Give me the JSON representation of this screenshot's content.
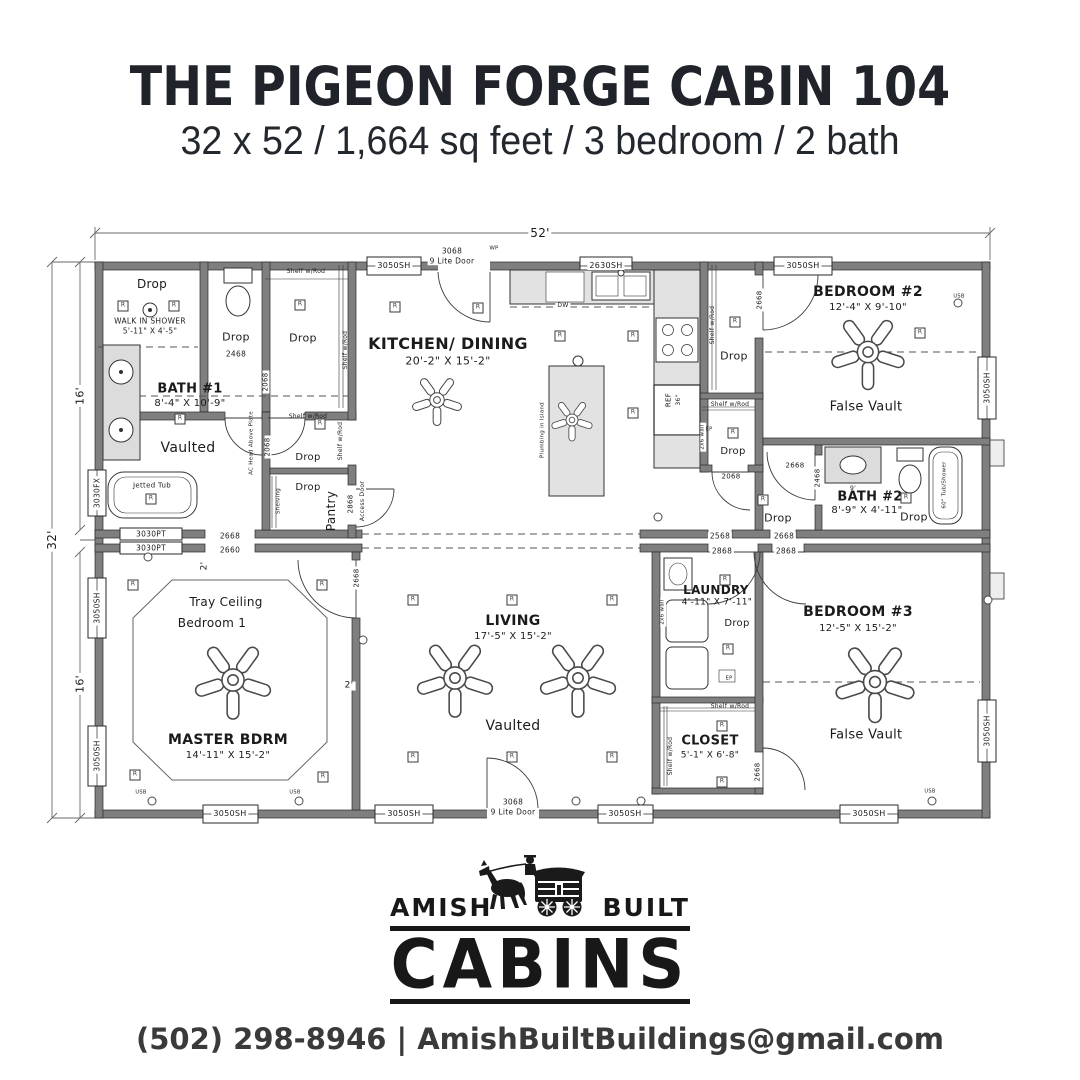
{
  "header": {
    "title": "THE PIGEON FORGE CABIN 104",
    "subtitle": "32 x 52 / 1,664 sq feet / 3 bedroom / 2 bath"
  },
  "logo": {
    "left": "AMISH",
    "right": "BUILT",
    "main": "CABINS"
  },
  "contact": {
    "line": "(502) 298-8946 | AmishBuiltBuildings@gmail.com"
  },
  "plan": {
    "colors": {
      "wall": "#7f7f7f",
      "counter": "#e2e2e2",
      "line": "#2b2b2b"
    },
    "labels": [
      {
        "t": "52'",
        "x": 540,
        "y": 233,
        "s": 12,
        "bg": 1
      },
      {
        "t": "32'",
        "x": 52,
        "y": 540,
        "s": 12,
        "r": -90,
        "bg": 1
      },
      {
        "t": "16'",
        "x": 80,
        "y": 396,
        "s": 11,
        "r": -90,
        "bg": 1
      },
      {
        "t": "16'",
        "x": 80,
        "y": 684,
        "s": 11,
        "r": -90,
        "bg": 1
      },
      {
        "t": "3050SH",
        "x": 394,
        "y": 266,
        "s": 8,
        "bg": 1
      },
      {
        "t": "3068",
        "x": 452,
        "y": 251,
        "s": 7.5,
        "bg": 1
      },
      {
        "t": "9 Lite Door",
        "x": 452,
        "y": 261,
        "s": 7.5,
        "bg": 1
      },
      {
        "t": "WP",
        "x": 494,
        "y": 249,
        "s": 5.5
      },
      {
        "t": "2630SH",
        "x": 606,
        "y": 266,
        "s": 8,
        "bg": 1
      },
      {
        "t": "3050SH",
        "x": 803,
        "y": 266,
        "s": 8,
        "bg": 1
      },
      {
        "t": "3030FX",
        "x": 97,
        "y": 493,
        "s": 7.5,
        "r": -90,
        "bg": 1
      },
      {
        "t": "3050SH",
        "x": 97,
        "y": 608,
        "s": 7.5,
        "r": -90,
        "bg": 1
      },
      {
        "t": "3050SH",
        "x": 97,
        "y": 756,
        "s": 7.5,
        "r": -90,
        "bg": 1
      },
      {
        "t": "3050SH",
        "x": 987,
        "y": 388,
        "s": 7.5,
        "r": -90,
        "bg": 1
      },
      {
        "t": "3050SH",
        "x": 987,
        "y": 731,
        "s": 7.5,
        "r": -90,
        "bg": 1
      },
      {
        "t": "3050SH",
        "x": 230,
        "y": 814,
        "s": 8,
        "bg": 1
      },
      {
        "t": "3050SH",
        "x": 404,
        "y": 814,
        "s": 8,
        "bg": 1
      },
      {
        "t": "3068",
        "x": 513,
        "y": 802,
        "s": 7.5,
        "bg": 1
      },
      {
        "t": "9 Lite Door",
        "x": 513,
        "y": 812,
        "s": 7.5,
        "bg": 1
      },
      {
        "t": "3050SH",
        "x": 625,
        "y": 814,
        "s": 8,
        "bg": 1
      },
      {
        "t": "3050SH",
        "x": 869,
        "y": 814,
        "s": 8,
        "bg": 1
      },
      {
        "t": "3030PT",
        "x": 151,
        "y": 534,
        "s": 7.5,
        "bg": 1
      },
      {
        "t": "3030PT",
        "x": 151,
        "y": 548,
        "s": 7.5,
        "bg": 1
      },
      {
        "t": "2668",
        "x": 230,
        "y": 536,
        "s": 7.5,
        "bg": 1
      },
      {
        "t": "2660",
        "x": 230,
        "y": 550,
        "s": 7.5,
        "bg": 1
      },
      {
        "t": "2568",
        "x": 720,
        "y": 536,
        "s": 7.5,
        "bg": 1
      },
      {
        "t": "2668",
        "x": 784,
        "y": 536,
        "s": 7.5,
        "bg": 1
      },
      {
        "t": "2868",
        "x": 722,
        "y": 551,
        "s": 7.5,
        "bg": 1
      },
      {
        "t": "2868",
        "x": 786,
        "y": 551,
        "s": 7.5,
        "bg": 1
      },
      {
        "t": "Drop",
        "x": 152,
        "y": 284,
        "s": 12
      },
      {
        "t": "WALK IN SHOWER",
        "x": 150,
        "y": 321,
        "s": 7.5
      },
      {
        "t": "5'-11\" X 4'-5\"",
        "x": 150,
        "y": 331,
        "s": 7.5
      },
      {
        "t": "Drop",
        "x": 236,
        "y": 337,
        "s": 11
      },
      {
        "t": "2468",
        "x": 236,
        "y": 354,
        "s": 7.5
      },
      {
        "t": "Drop",
        "x": 303,
        "y": 338,
        "s": 11
      },
      {
        "t": "Shelf w/Rod",
        "x": 306,
        "y": 272,
        "s": 6
      },
      {
        "t": "Shelf w/Rod",
        "x": 346,
        "y": 350,
        "s": 6,
        "r": -90
      },
      {
        "t": "2068",
        "x": 266,
        "y": 382,
        "s": 7,
        "r": -90,
        "bg": 1
      },
      {
        "t": "BATH #1",
        "x": 190,
        "y": 389,
        "s": 13,
        "b": 1
      },
      {
        "t": "8'-4\" X 10'-9\"",
        "x": 190,
        "y": 404,
        "s": 10
      },
      {
        "t": "Vaulted",
        "x": 188,
        "y": 448,
        "s": 14
      },
      {
        "t": "Jetted Tub",
        "x": 152,
        "y": 486,
        "s": 7
      },
      {
        "t": "AC Head Above Plate",
        "x": 252,
        "y": 443,
        "s": 5.5,
        "r": -90
      },
      {
        "t": "2068",
        "x": 268,
        "y": 447,
        "s": 7,
        "r": -90,
        "bg": 1
      },
      {
        "t": "Shelf w/Rod",
        "x": 308,
        "y": 417,
        "s": 6
      },
      {
        "t": "Shelf w/Rod",
        "x": 341,
        "y": 441,
        "s": 6,
        "r": -90
      },
      {
        "t": "Drop",
        "x": 308,
        "y": 458,
        "s": 10
      },
      {
        "t": "Shelving",
        "x": 279,
        "y": 501,
        "s": 5.5,
        "r": -90
      },
      {
        "t": "Drop",
        "x": 308,
        "y": 488,
        "s": 10
      },
      {
        "t": "Pantry",
        "x": 331,
        "y": 511,
        "s": 12,
        "r": -90
      },
      {
        "t": "2868",
        "x": 351,
        "y": 504,
        "s": 7,
        "r": -90,
        "bg": 1
      },
      {
        "t": "Access Door",
        "x": 363,
        "y": 501,
        "s": 6,
        "r": -90,
        "bg": 1
      },
      {
        "t": "KITCHEN/ DINING",
        "x": 448,
        "y": 344,
        "s": 16,
        "b": 1
      },
      {
        "t": "20'-2\" X 15'-2\"",
        "x": 448,
        "y": 361,
        "s": 11
      },
      {
        "t": "DW",
        "x": 563,
        "y": 306,
        "s": 6,
        "bg": 1
      },
      {
        "t": "Plumbing in Island",
        "x": 543,
        "y": 430,
        "s": 5.5,
        "r": -90
      },
      {
        "t": "REF",
        "x": 669,
        "y": 400,
        "s": 7,
        "r": -90
      },
      {
        "t": "36\"",
        "x": 679,
        "y": 400,
        "s": 6,
        "r": -90
      },
      {
        "t": "2x6 wall",
        "x": 703,
        "y": 437,
        "s": 5.5,
        "r": -90,
        "bg": 1
      },
      {
        "t": "Shelf w/Rod",
        "x": 713,
        "y": 325,
        "s": 6,
        "r": -90
      },
      {
        "t": "2668",
        "x": 760,
        "y": 300,
        "s": 7,
        "r": -90,
        "bg": 1
      },
      {
        "t": "Drop",
        "x": 734,
        "y": 356,
        "s": 11
      },
      {
        "t": "BEDROOM #2",
        "x": 868,
        "y": 292,
        "s": 14,
        "b": 1
      },
      {
        "t": "12'-4\" X 9'-10\"",
        "x": 868,
        "y": 308,
        "s": 10
      },
      {
        "t": "USB",
        "x": 959,
        "y": 297,
        "s": 5
      },
      {
        "t": "False Vault",
        "x": 866,
        "y": 407,
        "s": 13
      },
      {
        "t": "Shelf w/Rod",
        "x": 730,
        "y": 405,
        "s": 6
      },
      {
        "t": "EP",
        "x": 709,
        "y": 430,
        "s": 5
      },
      {
        "t": "Drop",
        "x": 733,
        "y": 452,
        "s": 10
      },
      {
        "t": "2068",
        "x": 731,
        "y": 477,
        "s": 7,
        "bg": 1
      },
      {
        "t": "Drop",
        "x": 778,
        "y": 518,
        "s": 11
      },
      {
        "t": "2668",
        "x": 795,
        "y": 466,
        "s": 7
      },
      {
        "t": "2468",
        "x": 818,
        "y": 478,
        "s": 7,
        "r": -90,
        "bg": 1
      },
      {
        "t": "BATH #2",
        "x": 870,
        "y": 497,
        "s": 13,
        "b": 1
      },
      {
        "t": "8'-9\" X 4'-11\"",
        "x": 867,
        "y": 511,
        "s": 10
      },
      {
        "t": "Drop",
        "x": 914,
        "y": 517,
        "s": 11
      },
      {
        "t": "9'",
        "x": 853,
        "y": 489,
        "s": 6
      },
      {
        "t": "60\" Tub/Shower",
        "x": 945,
        "y": 485,
        "s": 5.5,
        "r": -90
      },
      {
        "t": "2'",
        "x": 205,
        "y": 566,
        "s": 9,
        "r": -90,
        "bg": 1
      },
      {
        "t": "2'",
        "x": 349,
        "y": 686,
        "s": 9,
        "bg": 1
      },
      {
        "t": "Tray Ceiling",
        "x": 226,
        "y": 602,
        "s": 12
      },
      {
        "t": "Bedroom 1",
        "x": 212,
        "y": 623,
        "s": 12
      },
      {
        "t": "MASTER BDRM",
        "x": 228,
        "y": 740,
        "s": 14,
        "b": 1
      },
      {
        "t": "14'-11\" X 15'-2\"",
        "x": 228,
        "y": 756,
        "s": 10
      },
      {
        "t": "USB",
        "x": 141,
        "y": 793,
        "s": 5
      },
      {
        "t": "USB",
        "x": 295,
        "y": 793,
        "s": 5
      },
      {
        "t": "2668",
        "x": 357,
        "y": 578,
        "s": 7,
        "r": -90,
        "bg": 1
      },
      {
        "t": "LIVING",
        "x": 513,
        "y": 621,
        "s": 14,
        "b": 1
      },
      {
        "t": "17'-5\" X 15'-2\"",
        "x": 513,
        "y": 637,
        "s": 10
      },
      {
        "t": "Vaulted",
        "x": 513,
        "y": 726,
        "s": 14
      },
      {
        "t": "LAUNDRY",
        "x": 716,
        "y": 590,
        "s": 12,
        "b": 1
      },
      {
        "t": "4'-11\" X 7'-11\"",
        "x": 717,
        "y": 603,
        "s": 9
      },
      {
        "t": "Drop",
        "x": 737,
        "y": 624,
        "s": 10
      },
      {
        "t": "EP",
        "x": 729,
        "y": 679,
        "s": 5
      },
      {
        "t": "2x6 wall",
        "x": 663,
        "y": 612,
        "s": 5.5,
        "r": -90,
        "bg": 1
      },
      {
        "t": "Shelf w/Rod",
        "x": 730,
        "y": 707,
        "s": 6
      },
      {
        "t": "Shelf w/Rod",
        "x": 671,
        "y": 756,
        "s": 6,
        "r": -90
      },
      {
        "t": "CLOSET",
        "x": 710,
        "y": 741,
        "s": 13,
        "b": 1
      },
      {
        "t": "5'-1\" X 6'-8\"",
        "x": 710,
        "y": 756,
        "s": 9
      },
      {
        "t": "2668",
        "x": 758,
        "y": 772,
        "s": 7,
        "r": -90,
        "bg": 1
      },
      {
        "t": "BEDROOM #3",
        "x": 858,
        "y": 612,
        "s": 14,
        "b": 1
      },
      {
        "t": "12'-5\" X 15'-2\"",
        "x": 858,
        "y": 629,
        "s": 10
      },
      {
        "t": "False Vault",
        "x": 866,
        "y": 735,
        "s": 13
      },
      {
        "t": "USB",
        "x": 930,
        "y": 792,
        "s": 5
      }
    ],
    "lights": [
      [
        123,
        306
      ],
      [
        174,
        306
      ],
      [
        300,
        305
      ],
      [
        180,
        419
      ],
      [
        151,
        499
      ],
      [
        320,
        424
      ],
      [
        395,
        307
      ],
      [
        478,
        308
      ],
      [
        560,
        336
      ],
      [
        633,
        336
      ],
      [
        633,
        413
      ],
      [
        735,
        322
      ],
      [
        733,
        433
      ],
      [
        763,
        500
      ],
      [
        906,
        498
      ],
      [
        920,
        333
      ],
      [
        413,
        600
      ],
      [
        512,
        600
      ],
      [
        612,
        600
      ],
      [
        413,
        757
      ],
      [
        512,
        757
      ],
      [
        612,
        757
      ],
      [
        133,
        585
      ],
      [
        322,
        585
      ],
      [
        135,
        775
      ],
      [
        323,
        777
      ],
      [
        725,
        580
      ],
      [
        728,
        649
      ],
      [
        722,
        726
      ],
      [
        722,
        782
      ]
    ],
    "outlets": [
      [
        152,
        801
      ],
      [
        299,
        801
      ],
      [
        576,
        801
      ],
      [
        641,
        801
      ],
      [
        932,
        801
      ],
      [
        958,
        303
      ],
      [
        148,
        557
      ],
      [
        658,
        517
      ],
      [
        363,
        640
      ],
      [
        988,
        600
      ]
    ],
    "fans": [
      [
        437,
        400,
        0.85
      ],
      [
        572,
        420,
        0.7
      ],
      [
        868,
        352,
        1.25
      ],
      [
        233,
        680,
        1.3
      ],
      [
        455,
        678,
        1.3
      ],
      [
        578,
        678,
        1.3
      ],
      [
        875,
        682,
        1.35
      ]
    ]
  }
}
